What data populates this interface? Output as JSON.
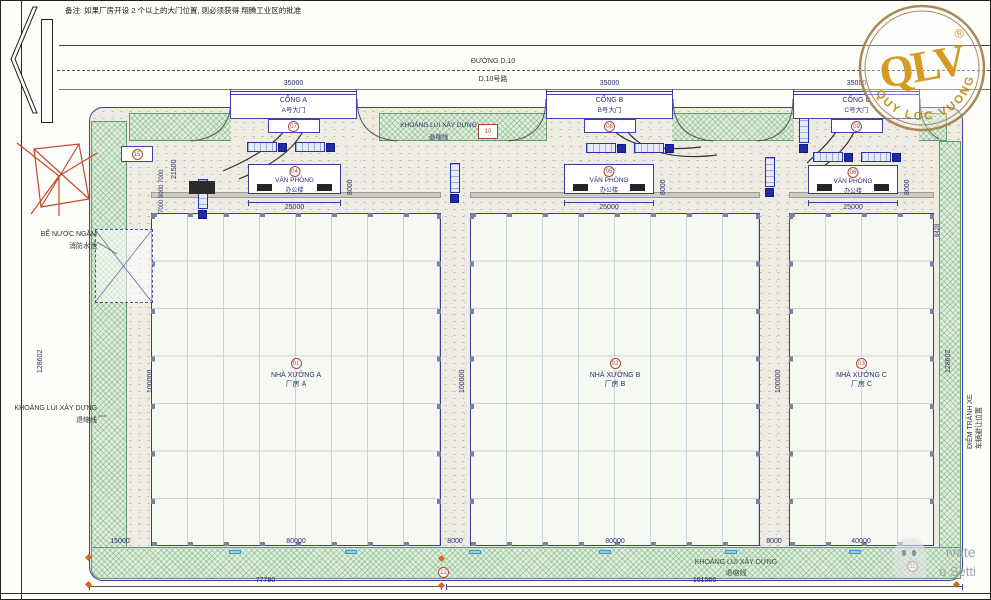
{
  "frame": {
    "note": "备注: 如果厂房开设 2 个以上的大门位置, 则必须获得 翔腾工业区的批准"
  },
  "road": {
    "name_vi": "ĐƯỜNG D.10",
    "name_cn": "D.10号路"
  },
  "gates": [
    {
      "ref": "07",
      "dim": "35000",
      "name_vi": "CỔNG A",
      "name_cn": "A号大门"
    },
    {
      "ref": "08",
      "dim": "35000",
      "name_vi": "CỔNG B",
      "name_cn": "B号大门"
    },
    {
      "ref": "09",
      "dim": "35000",
      "name_vi": "CỔNG C",
      "name_cn": "C号大门"
    }
  ],
  "setback": {
    "label_vi": "KHOẢNG LÙI XÂY DỰNG",
    "label_cn": "退缩线",
    "ref_top": "10",
    "ref_bottom": "12",
    "ref_corner": "11"
  },
  "offices": [
    {
      "ref": "04",
      "name_vi": "VĂN PHÒNG",
      "name_cn": "办公楼",
      "width": "25000",
      "depth": "8000"
    },
    {
      "ref": "05",
      "name_vi": "VĂN PHÒNG",
      "name_cn": "办公楼",
      "width": "25000",
      "depth": "8000"
    },
    {
      "ref": "06",
      "name_vi": "VĂN PHÒNG",
      "name_cn": "办公楼",
      "width": "25000",
      "depth": "8000"
    }
  ],
  "warehouses": [
    {
      "ref": "01",
      "name_vi": "NHÀ XƯỞNG A",
      "name_cn": "厂房 A",
      "width": "80000",
      "depth": "100000"
    },
    {
      "ref": "02",
      "name_vi": "NHÀ XƯỞNG B",
      "name_cn": "厂房 B",
      "width": "80000",
      "depth": "100000"
    },
    {
      "ref": "03",
      "name_vi": "NHÀ XƯỞNG C",
      "name_cn": "厂房 C",
      "width": "40000",
      "depth": "100000"
    }
  ],
  "water_tank": {
    "name_vi": "BỂ NƯỚC NGẦM",
    "name_cn": "消防水池"
  },
  "left_side": {
    "height_dim": "128602",
    "ref": "15",
    "stack_dims": "7000 9000 7000",
    "stack_total": "21500",
    "setback_vi": "KHOẢNG LÙI XÂY DỰNG",
    "setback_cn": "退缩线"
  },
  "right_side": {
    "height_dim": "128602",
    "avoid_vi": "ĐIỂM TRÁNH XE",
    "avoid_cn": "车辆避让位置",
    "misc_dim": "8428"
  },
  "bottom": {
    "left_block": "15000",
    "gap_ab": "8000",
    "gap_bc": "8000",
    "overall_left": "77780",
    "overall_right": "161566",
    "setback_vi": "KHOẢNG LÙI XÂY DỰNG",
    "setback_cn": "退缩线"
  },
  "stamp": {
    "brand": "QLV",
    "reg": "®",
    "ring_text": "QUY LOC VUONG"
  },
  "watermark": {
    "frag1": "ivate",
    "frag2": "o Setti"
  },
  "colors": {
    "stamp_gold": "#d29413",
    "line_navy": "#3a3a9a",
    "setback_green": "#679871",
    "compass_red": "#c44a2e",
    "truck_blue": "#1c2ba6"
  }
}
